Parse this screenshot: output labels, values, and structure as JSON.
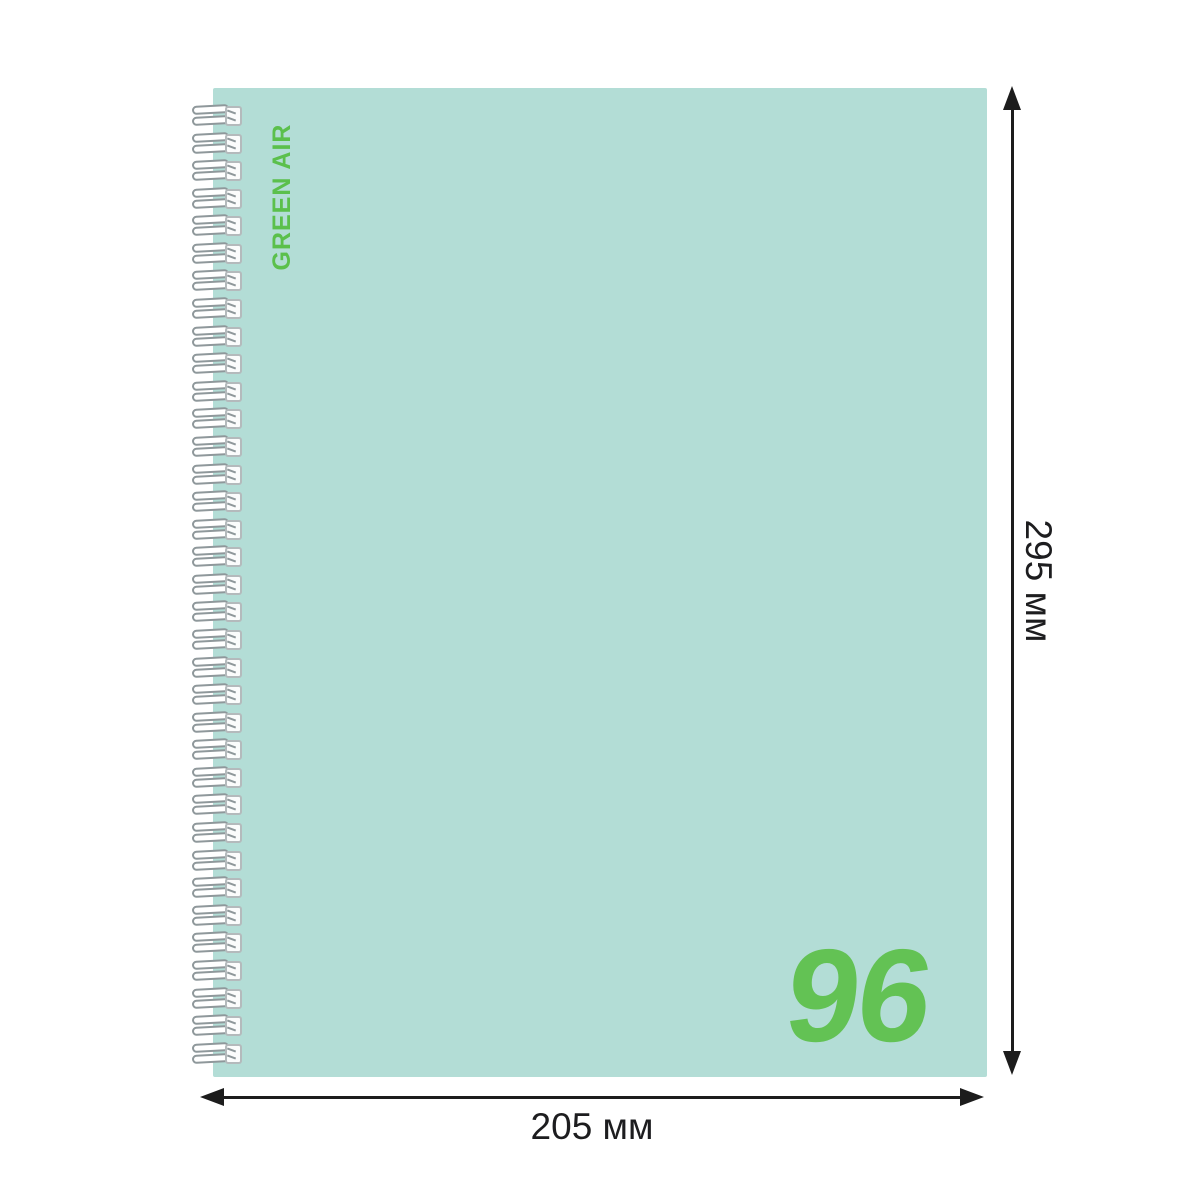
{
  "product": {
    "brand": "GREEN AIR",
    "sheet_count": "96"
  },
  "dimensions": {
    "height": "295 мм",
    "width": "205 мм"
  },
  "colors": {
    "cover": "#b3ddd6",
    "brand_green": "#5bc04c",
    "count_green": "#63c254",
    "wire_outline": "#8f989b",
    "line": "#1c1c1c"
  },
  "spiral": {
    "coil_count": 35
  }
}
